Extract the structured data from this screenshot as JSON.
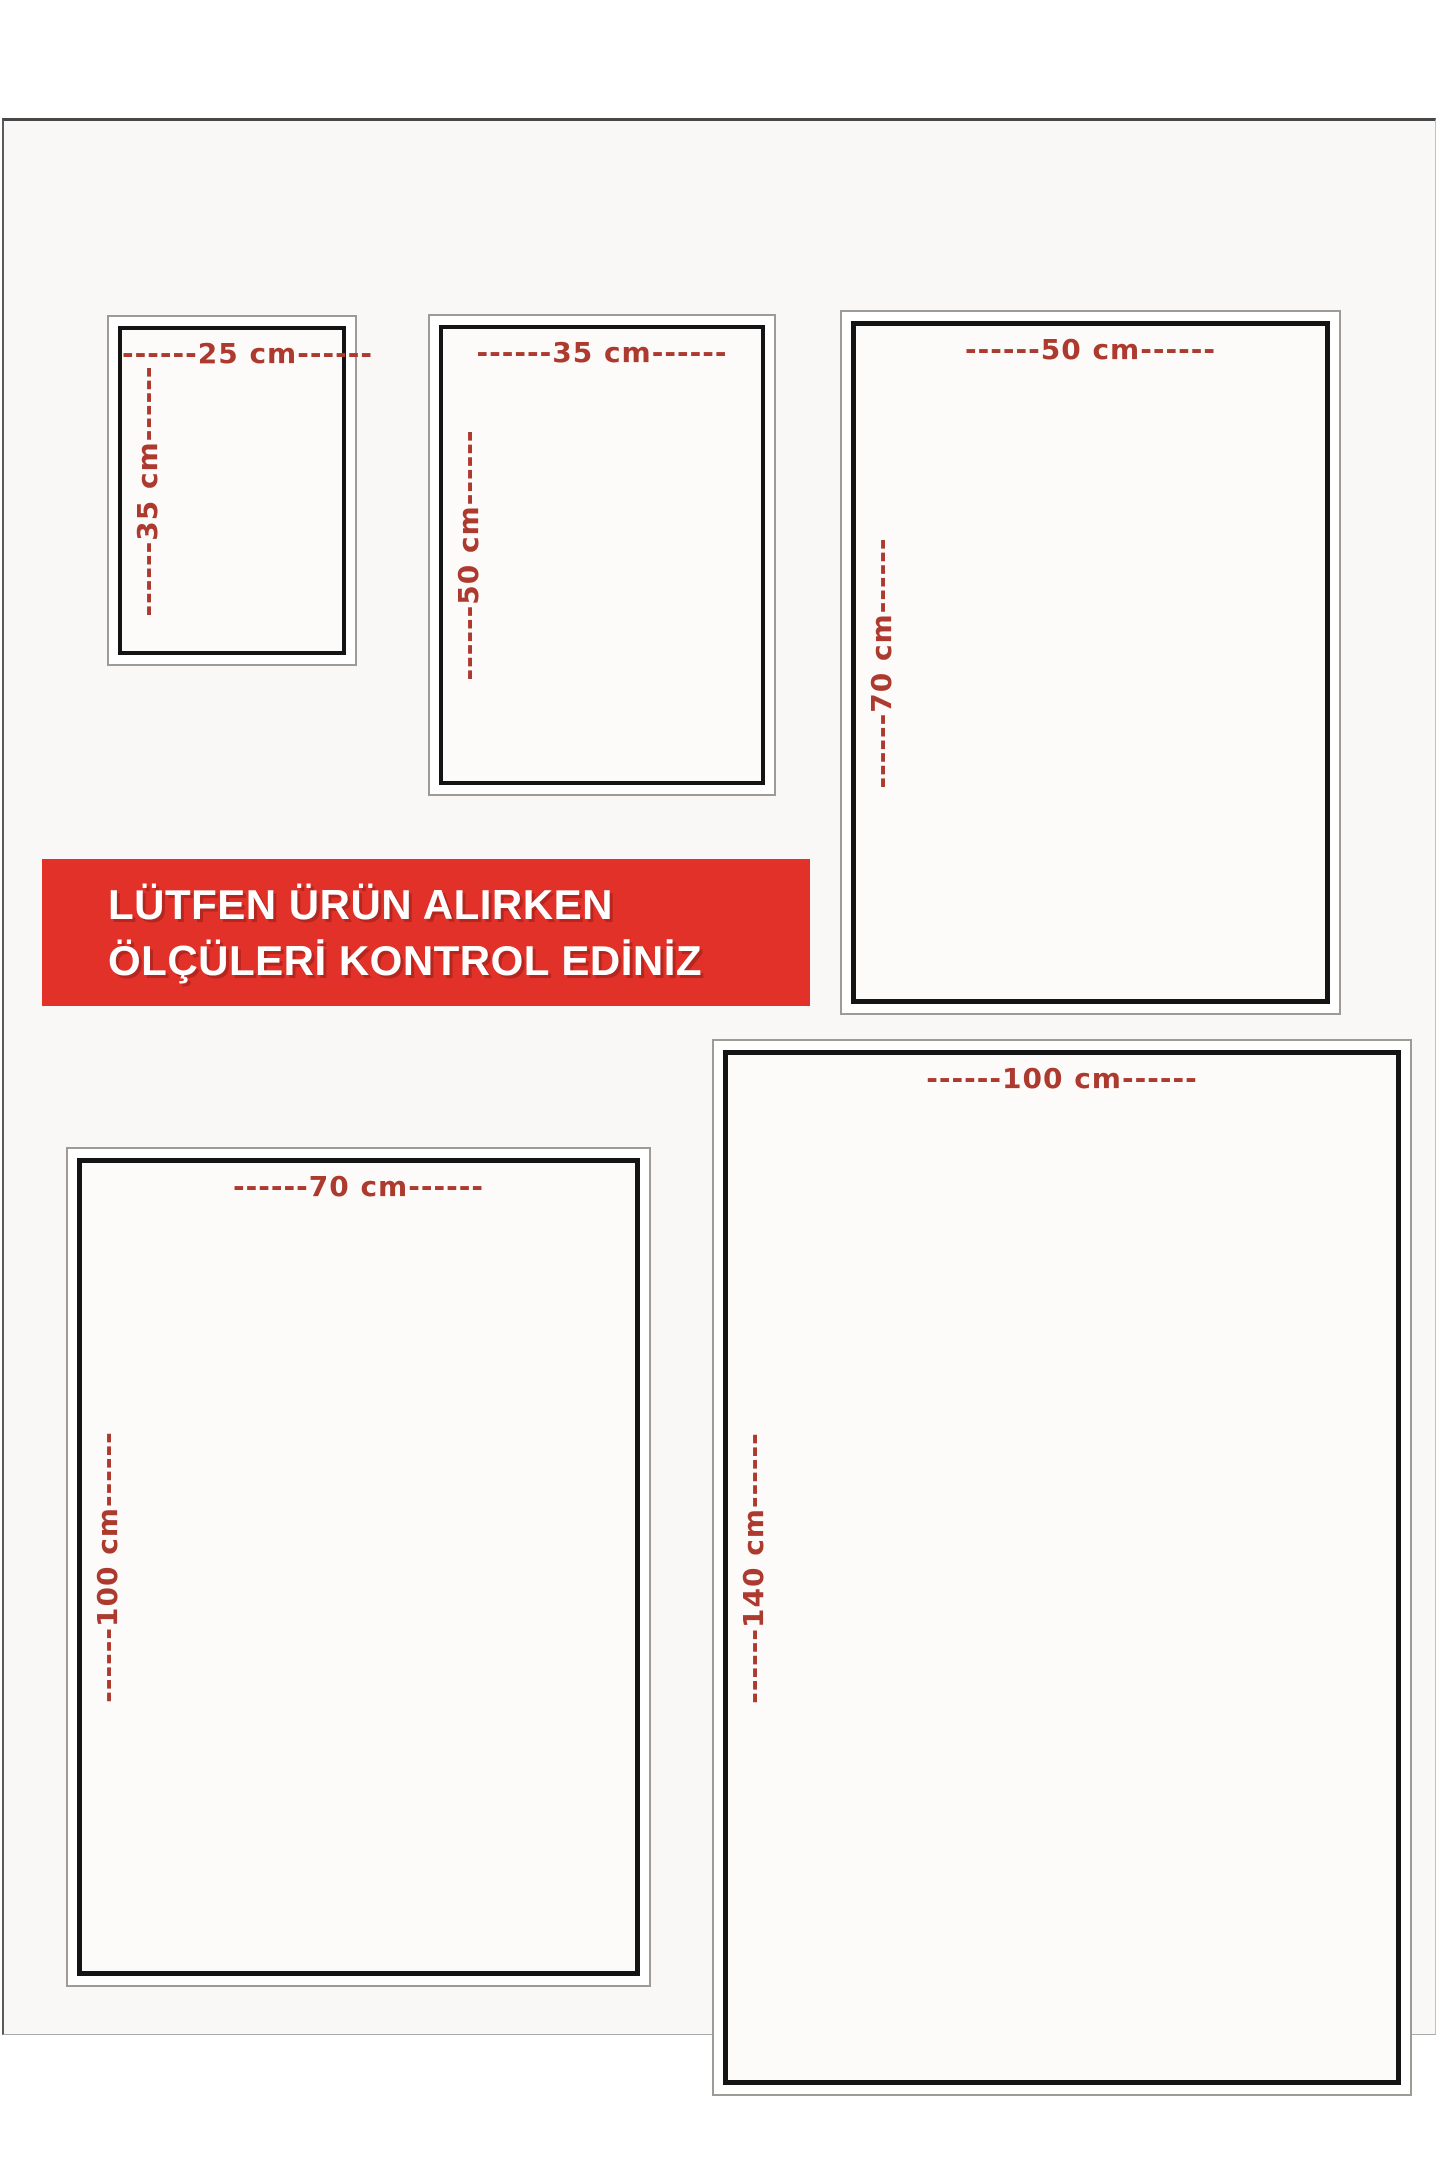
{
  "notice_banner": {
    "line1": "LÜTFEN ÜRÜN ALIRKEN",
    "line2": "ÖLÇÜLERİ KONTROL EDİNİZ"
  },
  "colors": {
    "banner_bg": "#e23128",
    "banner_text": "#ffffff",
    "dimension_label": "#ad3a2f",
    "box_border": "#141414"
  },
  "size_boxes": [
    {
      "name": "25x35",
      "width_cm": 25,
      "height_cm": 35,
      "width_label": "------25 cm------",
      "height_label": "------35 cm------"
    },
    {
      "name": "35x50",
      "width_cm": 35,
      "height_cm": 50,
      "width_label": "------35 cm------",
      "height_label": "------50 cm------"
    },
    {
      "name": "50x70",
      "width_cm": 50,
      "height_cm": 70,
      "width_label": "------50 cm------",
      "height_label": "------70 cm------"
    },
    {
      "name": "70x100",
      "width_cm": 70,
      "height_cm": 100,
      "width_label": "------70 cm------",
      "height_label": "------100 cm------"
    },
    {
      "name": "100x140",
      "width_cm": 100,
      "height_cm": 140,
      "width_label": "------100 cm------",
      "height_label": "------140 cm------"
    }
  ]
}
